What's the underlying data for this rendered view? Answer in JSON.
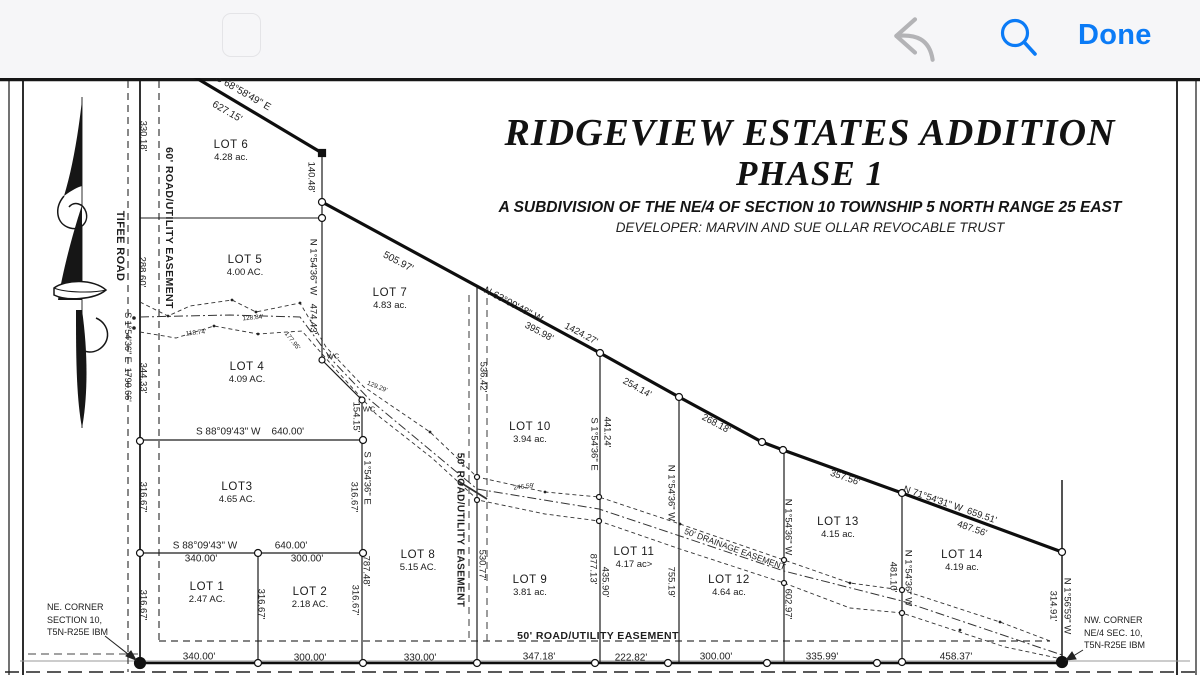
{
  "toolbar": {
    "done_label": "Done"
  },
  "title": {
    "line1": "RIDGEVIEW ESTATES ADDITION",
    "line2": "PHASE 1",
    "subtitle": "A SUBDIVISION OF THE NE/4 OF SECTION 10 TOWNSHIP 5 NORTH RANGE 25 EAST",
    "developer": "DEVELOPER: MARVIN AND SUE OLLAR REVOCABLE TRUST"
  },
  "plat": {
    "lots": [
      {
        "name": "LOT 6",
        "area": "4.28 ac.",
        "x": 231,
        "y": 151
      },
      {
        "name": "LOT 5",
        "area": "4.00 AC.",
        "x": 245,
        "y": 266
      },
      {
        "name": "LOT 7",
        "area": "4.83 ac.",
        "x": 390,
        "y": 299
      },
      {
        "name": "LOT 4",
        "area": "4.09 AC.",
        "x": 247,
        "y": 373
      },
      {
        "name": "LOT3",
        "area": "4.65 AC.",
        "x": 237,
        "y": 493
      },
      {
        "name": "LOT 1",
        "area": "2.47 AC.",
        "x": 207,
        "y": 593
      },
      {
        "name": "LOT 2",
        "area": "2.18 AC.",
        "x": 310,
        "y": 598
      },
      {
        "name": "LOT 8",
        "area": "5.15 AC.",
        "x": 418,
        "y": 561
      },
      {
        "name": "LOT 9",
        "area": "3.81 ac.",
        "x": 530,
        "y": 586
      },
      {
        "name": "LOT 10",
        "area": "3.94 ac.",
        "x": 530,
        "y": 433
      },
      {
        "name": "LOT 11",
        "area": "4.17 ac>",
        "x": 634,
        "y": 558
      },
      {
        "name": "LOT 12",
        "area": "4.64 ac.",
        "x": 729,
        "y": 586
      },
      {
        "name": "LOT 13",
        "area": "4.15 ac.",
        "x": 838,
        "y": 528
      },
      {
        "name": "LOT 14",
        "area": "4.19 ac.",
        "x": 962,
        "y": 561
      }
    ],
    "labels": [
      {
        "t": "S 68°58'49\" E",
        "x": 243,
        "y": 93,
        "r": 30,
        "s": 10
      },
      {
        "t": "627.15'",
        "x": 227,
        "y": 112,
        "r": 30,
        "s": 10
      },
      {
        "t": "330.18'",
        "x": 143,
        "y": 136,
        "r": 90
      },
      {
        "t": "288.60'",
        "x": 142,
        "y": 272,
        "r": 90
      },
      {
        "t": "344.33'",
        "x": 143,
        "y": 378,
        "r": 90
      },
      {
        "t": "316.67'",
        "x": 143,
        "y": 497,
        "r": 90
      },
      {
        "t": "316.67'",
        "x": 143,
        "y": 605,
        "r": 90
      },
      {
        "t": "TIFEE ROAD",
        "x": 120,
        "y": 246,
        "r": 90,
        "s": 11,
        "w": 1
      },
      {
        "t": "S 1°54'36\" E  1790.66'",
        "x": 128,
        "y": 357,
        "r": 90,
        "s": 9
      },
      {
        "t": "60' ROAD/UTILITY EASEMENT",
        "x": 169,
        "y": 228,
        "r": 90,
        "s": 10.5,
        "w": 1
      },
      {
        "t": "140.48'",
        "x": 311,
        "y": 177,
        "r": 90
      },
      {
        "t": "N 1°54'36\" W",
        "x": 313,
        "y": 267,
        "r": 90
      },
      {
        "t": "474.43'",
        "x": 313,
        "y": 319,
        "r": 90
      },
      {
        "t": "505.97'",
        "x": 398,
        "y": 262,
        "r": 28,
        "s": 10
      },
      {
        "t": "N 63°09'48\" W",
        "x": 513,
        "y": 305,
        "r": 28,
        "s": 10
      },
      {
        "t": "395.98'",
        "x": 539,
        "y": 332,
        "r": 28
      },
      {
        "t": "1424.27'",
        "x": 581,
        "y": 334,
        "r": 28
      },
      {
        "t": "254.14'",
        "x": 637,
        "y": 388,
        "r": 29
      },
      {
        "t": "268.18'",
        "x": 716,
        "y": 424,
        "r": 28
      },
      {
        "t": "357.56'",
        "x": 845,
        "y": 478,
        "r": 19
      },
      {
        "t": "N 71°54'31\" W  659.51'",
        "x": 950,
        "y": 505,
        "r": 19,
        "s": 9.5
      },
      {
        "t": "487.56'",
        "x": 972,
        "y": 529,
        "r": 19
      },
      {
        "t": "536.42'",
        "x": 483,
        "y": 377,
        "r": 90
      },
      {
        "t": "530.77'",
        "x": 482,
        "y": 565,
        "r": 90
      },
      {
        "t": "50' ROAD/UTILITY EASEMENT",
        "x": 460,
        "y": 530,
        "r": 90,
        "s": 10,
        "w": 1
      },
      {
        "t": "S 1°54'36\" E",
        "x": 594,
        "y": 444,
        "r": 90
      },
      {
        "t": "441.24'",
        "x": 607,
        "y": 432,
        "r": 90
      },
      {
        "t": "877.13'",
        "x": 593,
        "y": 569,
        "r": 90
      },
      {
        "t": "435.90'",
        "x": 605,
        "y": 582,
        "r": 90
      },
      {
        "t": "N 1°54'36\" W",
        "x": 671,
        "y": 493,
        "r": 90
      },
      {
        "t": "755.19'",
        "x": 671,
        "y": 582,
        "r": 90
      },
      {
        "t": "N 1°54'36\" W",
        "x": 788,
        "y": 527,
        "r": 90
      },
      {
        "t": "602.97'",
        "x": 788,
        "y": 604,
        "r": 90
      },
      {
        "t": "481.10'",
        "x": 893,
        "y": 577,
        "r": 90
      },
      {
        "t": "N 1°54'36\" W",
        "x": 908,
        "y": 578,
        "r": 90
      },
      {
        "t": "314.91'",
        "x": 1053,
        "y": 606,
        "r": 90
      },
      {
        "t": "N 1°56'59\" W",
        "x": 1067,
        "y": 606,
        "r": 90
      },
      {
        "t": "S 1°54'36\" E",
        "x": 367,
        "y": 478,
        "r": 90
      },
      {
        "t": "316.67'",
        "x": 354,
        "y": 497,
        "r": 90
      },
      {
        "t": "787.48'",
        "x": 366,
        "y": 571,
        "r": 90
      },
      {
        "t": "316.67'",
        "x": 355,
        "y": 600,
        "r": 90
      },
      {
        "t": "154.15'",
        "x": 356,
        "y": 417,
        "r": 90
      },
      {
        "t": "316.67'",
        "x": 261,
        "y": 604,
        "r": 90
      },
      {
        "t": "S 88°09'43\" W    640.00'",
        "x": 250,
        "y": 432,
        "s": 10
      },
      {
        "t": "S 88°09'43\" W",
        "x": 205,
        "y": 546,
        "s": 10
      },
      {
        "t": "640.00'",
        "x": 291,
        "y": 546,
        "s": 10
      },
      {
        "t": "340.00'",
        "x": 201,
        "y": 559,
        "s": 10
      },
      {
        "t": "300.00'",
        "x": 307,
        "y": 559,
        "s": 10
      },
      {
        "t": "340.00'",
        "x": 199,
        "y": 657,
        "s": 10
      },
      {
        "t": "300.00'",
        "x": 310,
        "y": 658,
        "s": 10
      },
      {
        "t": "330.00'",
        "x": 420,
        "y": 658,
        "s": 10
      },
      {
        "t": "347.18'",
        "x": 539,
        "y": 657,
        "s": 10
      },
      {
        "t": "222.82'",
        "x": 631,
        "y": 658,
        "s": 10
      },
      {
        "t": "300.00'",
        "x": 716,
        "y": 657,
        "s": 10
      },
      {
        "t": "335.99'",
        "x": 822,
        "y": 657,
        "s": 10
      },
      {
        "t": "458.37'",
        "x": 956,
        "y": 657,
        "s": 10
      },
      {
        "t": "50' ROAD/UTILITY EASEMENT",
        "x": 598,
        "y": 636,
        "s": 10.5,
        "w": 1
      },
      {
        "t": "50' DRAINAGE EASEMENT",
        "x": 735,
        "y": 549,
        "r": 20,
        "s": 8.5
      },
      {
        "t": "246.59'",
        "x": 524,
        "y": 487,
        "r": -6,
        "s": 6.5
      },
      {
        "t": "118.74'",
        "x": 196,
        "y": 333,
        "r": -6,
        "s": 6.5
      },
      {
        "t": "128.84'",
        "x": 253,
        "y": 318,
        "r": -5,
        "s": 6.5
      },
      {
        "t": "177.95'",
        "x": 292,
        "y": 341,
        "r": 52,
        "s": 6.5
      },
      {
        "t": "129.29'",
        "x": 377,
        "y": 387,
        "r": 22,
        "s": 6.5
      },
      {
        "t": "WC",
        "x": 333,
        "y": 356,
        "s": 7.5
      },
      {
        "t": "WC",
        "x": 369,
        "y": 409,
        "s": 7.5
      }
    ],
    "corner_notes": [
      {
        "lines": [
          "NE. CORNER",
          "SECTION 10,",
          "T5N-R25E IBM"
        ],
        "x": 47,
        "y": 601
      },
      {
        "lines": [
          "NW. CORNER",
          "NE/4 SEC. 10,",
          "T5N-R25E IBM"
        ],
        "x": 1084,
        "y": 614
      }
    ]
  },
  "colors": {
    "accent_blue": "#0b7bf6",
    "undo_gray": "#b3b3b6",
    "ink": "#161616"
  }
}
